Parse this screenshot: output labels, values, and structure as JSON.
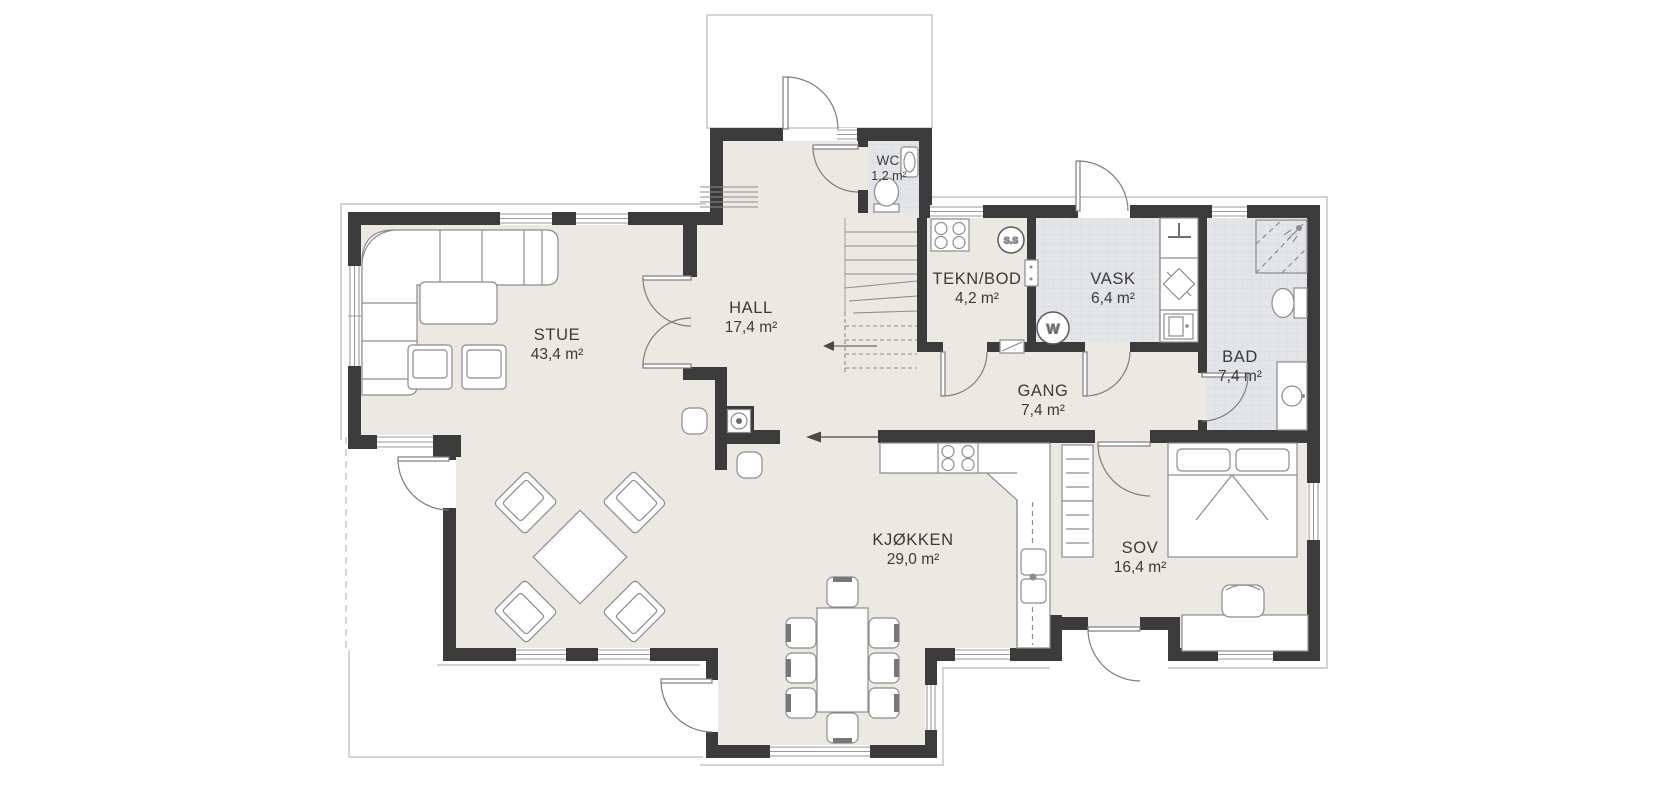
{
  "plan": {
    "kind": "floor-plan",
    "rooms": [
      {
        "id": "stue",
        "name": "STUE",
        "area": "43,4 m²"
      },
      {
        "id": "hall",
        "name": "HALL",
        "area": "17,4 m²"
      },
      {
        "id": "wc",
        "name": "WC",
        "area": "1,2 m²"
      },
      {
        "id": "teknbod",
        "name": "TEKN/BOD",
        "area": "4,2 m²"
      },
      {
        "id": "vask",
        "name": "VASK",
        "area": "6,4 m²"
      },
      {
        "id": "bad",
        "name": "BAD",
        "area": "7,4 m²"
      },
      {
        "id": "gang",
        "name": "GANG",
        "area": "7,4 m²"
      },
      {
        "id": "kjokken",
        "name": "KJØKKEN",
        "area": "29,0 m²"
      },
      {
        "id": "sov",
        "name": "SOV",
        "area": "16,4 m²"
      }
    ],
    "symbols": {
      "ss": "S.S",
      "w": "W"
    },
    "colors": {
      "wall": "#3b3b3b",
      "floor": "#ebe9e1",
      "tile": "#e3e5e9",
      "line": "#8c8c8c",
      "background": "#ffffff"
    }
  }
}
